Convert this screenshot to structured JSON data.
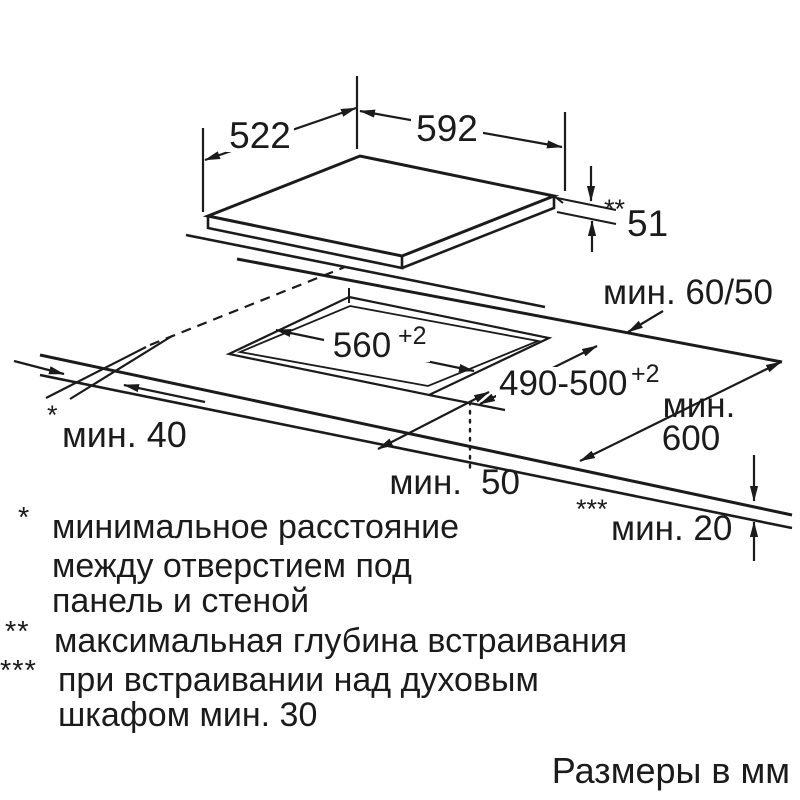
{
  "diagram": {
    "panel": {
      "width": "522",
      "length": "592",
      "build_depth_marker": "**",
      "build_depth": "51"
    },
    "cutout": {
      "width": "560",
      "width_tolerance": "+2",
      "depth": "490-500",
      "depth_tolerance": "+2"
    },
    "clearances": {
      "rear": "мин. 60/50",
      "side_marker": "*",
      "side": "мин. 40",
      "worktop_depth_word": "мин.",
      "worktop_depth_value": "600",
      "front_word": "мин.",
      "front_value": "50",
      "under_marker": "***",
      "under": "мин. 20"
    }
  },
  "footnotes": [
    {
      "marker": "*",
      "lines": [
        "минимальное расстояние",
        "между отверстием под",
        "панель и стеной"
      ]
    },
    {
      "marker": "**",
      "lines": [
        "максимальная глубина встраивания"
      ]
    },
    {
      "marker": "***",
      "lines": [
        "при встраивании над духовым",
        "шкафом мин. 30"
      ]
    }
  ],
  "units_note": "Размеры в мм",
  "colors": {
    "ink": "#1b1b1b",
    "background": "#ffffff"
  }
}
